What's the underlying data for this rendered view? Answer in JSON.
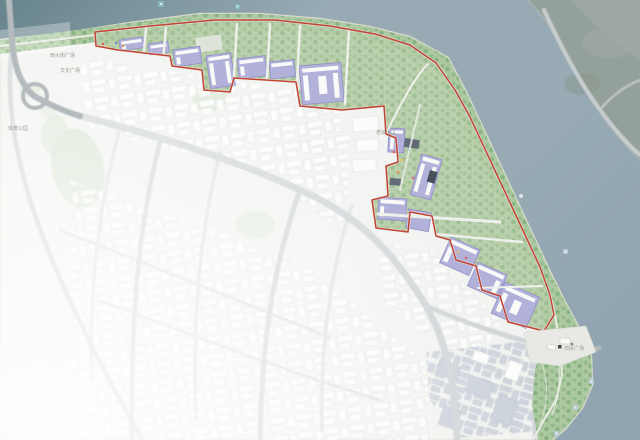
{
  "map": {
    "labels": [
      {
        "id": "plaza-west",
        "text": "西大街广场"
      },
      {
        "id": "culture-plaza",
        "text": "文化广场"
      },
      {
        "id": "park-west",
        "text": "体育公园"
      },
      {
        "id": "old-town",
        "text": "老城小区"
      },
      {
        "id": "civic-plaza",
        "text": "市民广场"
      }
    ],
    "icons": {
      "water_markers": "map-poi-icon",
      "buoy": "buoy-dot-icon",
      "civic_plaza_marker": "building-marker-icon"
    },
    "palette": {
      "water_deep": "#5f7d86",
      "water": "#93a7b1",
      "water_edge": "#8ba0ad",
      "land": "#e9ebe7",
      "land_far": "#8f9c95",
      "road": "#b0b7ba",
      "road_light": "#c6cbcd",
      "road_white": "#eef0ea",
      "sand": "#d6d8ca",
      "green_strip": "#a9c79d",
      "corridor_green": "#b3cba4",
      "tree": "#79a873",
      "tree_dark": "#63985f",
      "boundary_red": "#bf3a2b",
      "parcel_purple": "#aeadd9",
      "parcel_outline": "#8d8bc4",
      "building_white": "#fafbf8",
      "building_outline": "#c7ccc7",
      "building_blue": "#a9b3c2",
      "building_blue_outline": "#929db0",
      "roof_dark": "#5b6472",
      "plaza": "#e7e8e4",
      "label_gray": "#82877f",
      "marker_teal": "#7fb6bd",
      "marker_light": "#b7c9d6"
    }
  }
}
